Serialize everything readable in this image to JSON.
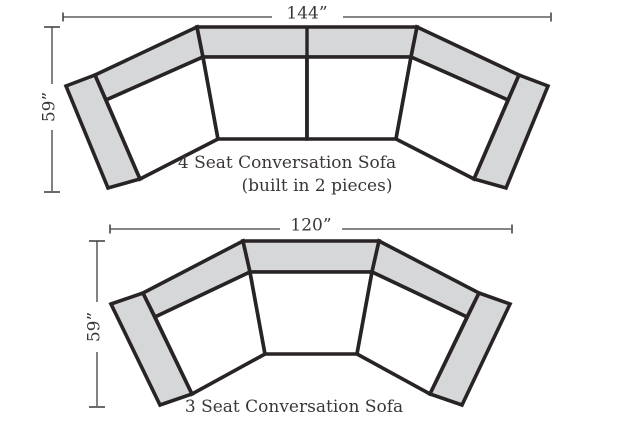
{
  "colors": {
    "background": "#ffffff",
    "cushion_gray": "#d6d7d8",
    "seat_white": "#ffffff",
    "outline": "#282425",
    "dimension_line": "#3f3f3f",
    "text": "#3a3637"
  },
  "sofa_4_seat": {
    "width_label": "144”",
    "height_label": "59”",
    "caption_line_1": "4 Seat Conversation Sofa",
    "caption_line_2": "(built in 2 pieces)"
  },
  "sofa_3_seat": {
    "width_label": "120”",
    "height_label": "59”",
    "caption_line_1": "3 Seat Conversation Sofa"
  }
}
